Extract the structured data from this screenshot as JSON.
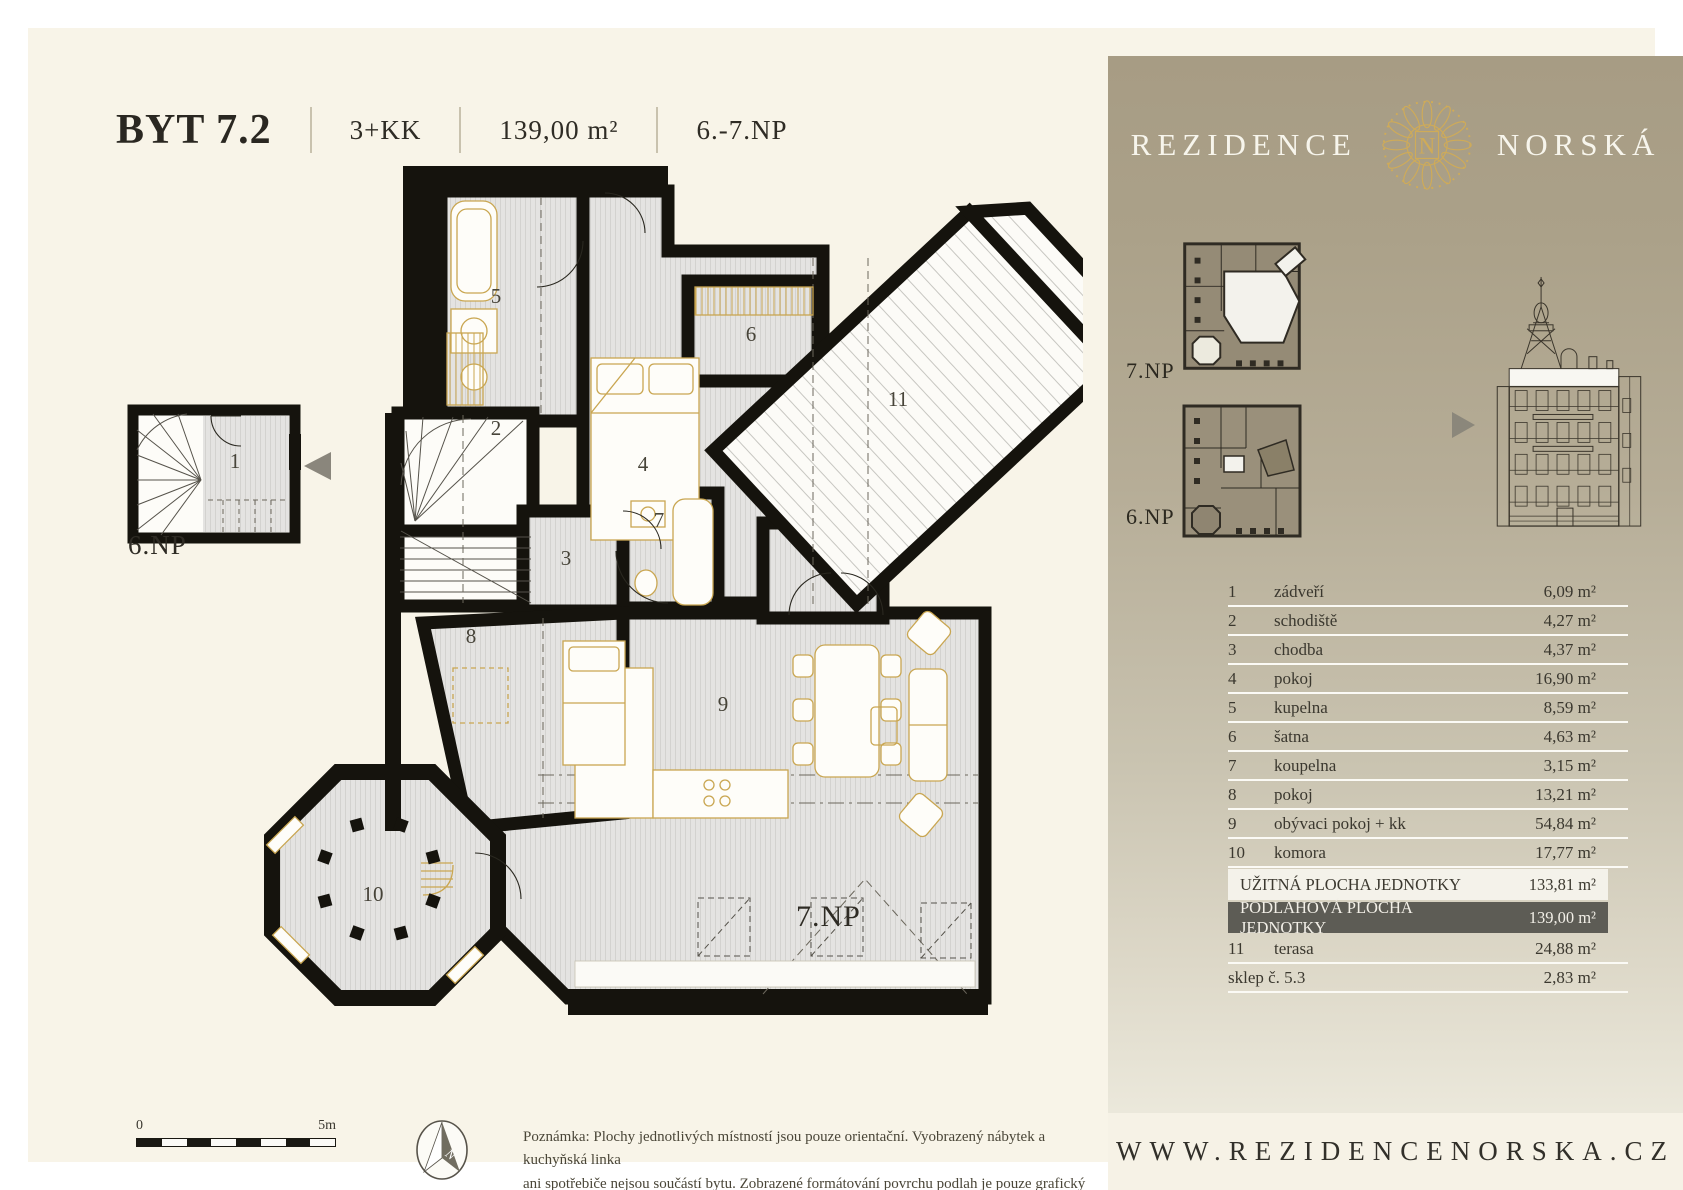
{
  "header": {
    "unit_label": "BYT 7.2",
    "disposition": "3+KK",
    "area": "139,00 m²",
    "floors": "6.-7.NP"
  },
  "floor_plan": {
    "main_floor_label": "7.NP",
    "small_plan_floor_label": "6.NP",
    "room_labels": {
      "r1": "1",
      "r2": "2",
      "r3": "3",
      "r4": "4",
      "r5": "5",
      "r6": "6",
      "r7": "7",
      "r8": "8",
      "r9": "9",
      "r10": "10",
      "r11": "11"
    }
  },
  "scale_bar": {
    "start_label": "0",
    "end_label": "5m"
  },
  "compass": {
    "north_letter": "N"
  },
  "note": {
    "line1": "Poznámka: Plochy jednotlivých místností jsou pouze orientační. Vyobrazený nábytek a kuchyňská linka",
    "line2": "ani spotřebiče nejsou součástí bytu. Zobrazené formátování povrchu podlah je pouze grafický symbol."
  },
  "sidebar": {
    "brand": {
      "left": "REZIDENCE",
      "right": "NORSKÁ",
      "monogram": "N"
    },
    "mini_plans": {
      "upper_label": "7.NP",
      "lower_label": "6.NP"
    },
    "rooms": [
      {
        "num": "1",
        "name": "zádveří",
        "area": "6,09 m²"
      },
      {
        "num": "2",
        "name": "schodiště",
        "area": "4,27 m²"
      },
      {
        "num": "3",
        "name": "chodba",
        "area": "4,37 m²"
      },
      {
        "num": "4",
        "name": "pokoj",
        "area": "16,90 m²"
      },
      {
        "num": "5",
        "name": "kupelna",
        "area": "8,59 m²"
      },
      {
        "num": "6",
        "name": "šatna",
        "area": "4,63 m²"
      },
      {
        "num": "7",
        "name": "koupelna",
        "area": "3,15 m²"
      },
      {
        "num": "8",
        "name": "pokoj",
        "area": "13,21 m²"
      },
      {
        "num": "9",
        "name": "obývaci pokoj + kk",
        "area": "54,84 m²"
      },
      {
        "num": "10",
        "name": "komora",
        "area": "17,77 m²"
      }
    ],
    "summary": {
      "usable": {
        "label": "UŽITNÁ PLOCHA JEDNOTKY",
        "area": "133,81 m²"
      },
      "floor": {
        "label": "PODLAHOVÁ PLOCHA JEDNOTKY",
        "area": "139,00 m²"
      }
    },
    "extra_rooms": [
      {
        "num": "11",
        "name": "terasa",
        "area": "24,88 m²"
      },
      {
        "num": "",
        "name": "sklep č. 5.3",
        "area": "2,83 m²"
      }
    ],
    "website": "WWW.REZIDENCENORSKA.CZ"
  },
  "colors": {
    "page_background": "#f8f4e8",
    "sidebar_top": "#a79c84",
    "sidebar_bottom": "#eeebdf",
    "brand_gold": "#c9a651",
    "wall_black": "#15130d",
    "dark_row": "#5d5c55",
    "light_row": "#f4f2ea"
  }
}
